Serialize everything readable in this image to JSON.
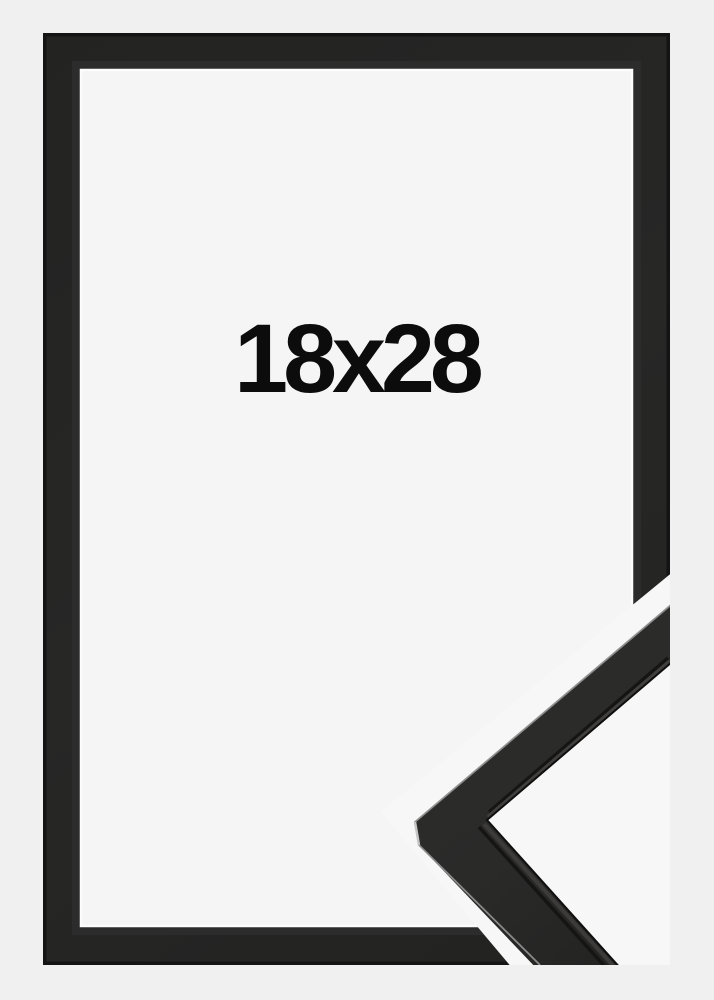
{
  "product_image": {
    "size_label": "18x28",
    "description": "Black picture frame shown flat with a diagonal cut-away revealing a 3D corner profile of the moulding",
    "frame_color_name": "black",
    "colors": {
      "background": "#f0f0f1",
      "frame_black": "#262625",
      "frame_edge_dark": "#141414",
      "mat_white": "#f5f5f5",
      "mat_highlight": "#fcfcfc",
      "cutaway_band": "#f7f7f8",
      "profile_face": "#2c2c2b",
      "profile_highlight": "#8e8e8e",
      "label_text": "#0c0c0c"
    }
  }
}
